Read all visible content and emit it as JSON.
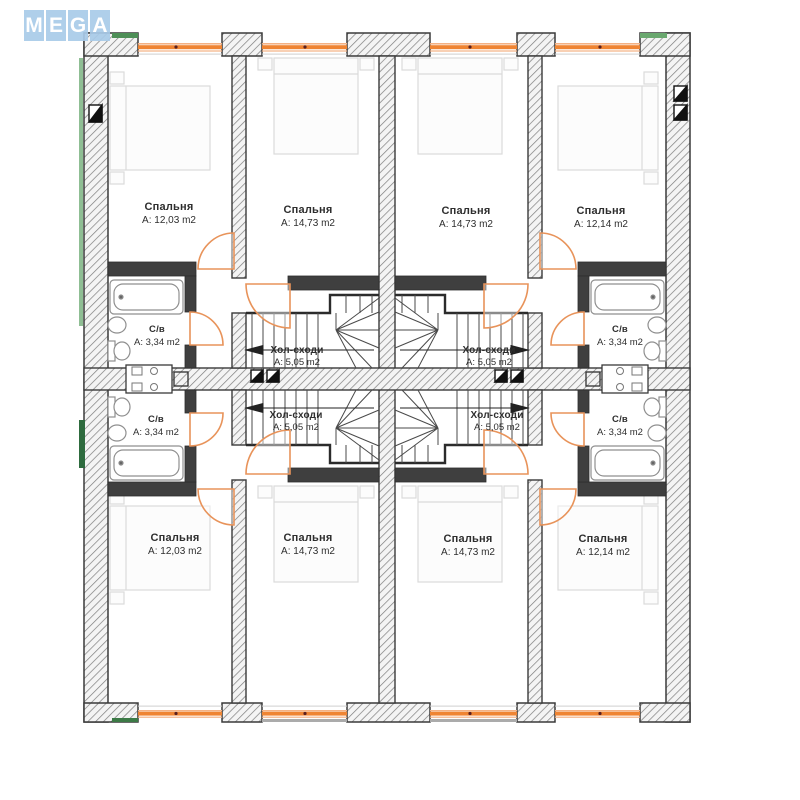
{
  "logo": {
    "text": "MEGA",
    "letters": [
      "M",
      "E",
      "G",
      "A"
    ]
  },
  "plan": {
    "bedrooms": [
      {
        "position": "top-left",
        "name": "Спальня",
        "area": "А: 12,03 m2"
      },
      {
        "position": "top-mid-left",
        "name": "Спальня",
        "area": "А: 14,73 m2"
      },
      {
        "position": "top-mid-right",
        "name": "Спальня",
        "area": "А: 14,73 m2"
      },
      {
        "position": "top-right",
        "name": "Спальня",
        "area": "А: 12,14 m2"
      },
      {
        "position": "bottom-left",
        "name": "Спальня",
        "area": "А: 12,03 m2"
      },
      {
        "position": "bottom-mid-left",
        "name": "Спальня",
        "area": "А: 14,73 m2"
      },
      {
        "position": "bottom-mid-right",
        "name": "Спальня",
        "area": "А: 14,73 m2"
      },
      {
        "position": "bottom-right",
        "name": "Спальня",
        "area": "А: 12,14 m2"
      }
    ],
    "bathrooms": [
      {
        "position": "top-left",
        "name": "С/в",
        "area": "А: 3,34 m2"
      },
      {
        "position": "top-right",
        "name": "С/в",
        "area": "А: 3,34 m2"
      },
      {
        "position": "bottom-left",
        "name": "С/в",
        "area": "А: 3,34 m2"
      },
      {
        "position": "bottom-right",
        "name": "С/в",
        "area": "А: 3,34 m2"
      }
    ],
    "halls": [
      {
        "position": "top-left",
        "name": "Хол-сходи",
        "area": "А: 5,05 m2"
      },
      {
        "position": "top-right",
        "name": "Хол-сходи",
        "area": "А: 5,05 m2"
      },
      {
        "position": "bottom-left",
        "name": "Хол-сходи",
        "area": "А: 5,05 m2"
      },
      {
        "position": "bottom-right",
        "name": "Хол-сходи",
        "area": "А: 5,05 m2"
      }
    ]
  },
  "colors": {
    "window_orange": "#ef8432",
    "insulation_green": "#4e8f57",
    "wall_dark": "#3a3a3a",
    "logo_blue": "#a9cbe9"
  }
}
